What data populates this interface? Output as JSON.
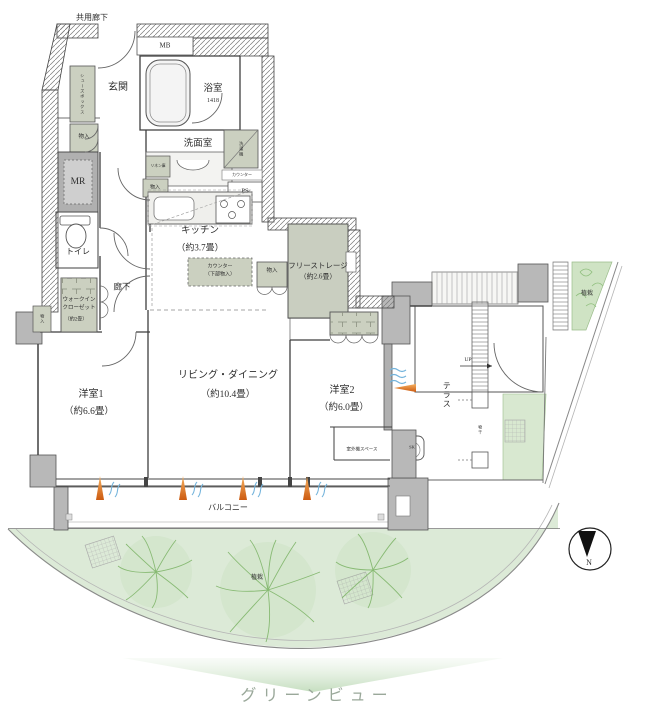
{
  "plan": {
    "exterior": {
      "common_corridor": "共用廊下",
      "mb": "MB",
      "up": "UP",
      "planting_top": "植栽",
      "planting_garden": "植栽",
      "green_view": "グリーンビュー",
      "north": "N"
    },
    "rooms": {
      "entrance": {
        "label": "玄関"
      },
      "bathroom": {
        "label": "浴室",
        "size": "1418"
      },
      "washroom": {
        "label": "洗面室"
      },
      "kitchen": {
        "label": "キッチン",
        "size": "（約3.7畳）"
      },
      "toilet": {
        "label": "トイレ"
      },
      "hallway": {
        "label": "廊下"
      },
      "bedroom1": {
        "label": "洋室1",
        "size": "（約6.6畳）"
      },
      "living_dining": {
        "label": "リビング・ダイニング",
        "size": "（約10.4畳）"
      },
      "bedroom2": {
        "label": "洋室2",
        "size": "（約6.0畳）"
      },
      "free_storage": {
        "label": "フリーストレージ",
        "size": "（約2.6畳）"
      },
      "walk_in_closet": {
        "line1": "ウォークイン",
        "line2": "クローゼット",
        "size": "（約2畳）"
      },
      "balcony": {
        "label": "バルコニー"
      },
      "terrace": {
        "label": "テラス"
      }
    },
    "fixtures": {
      "meter_room": "MR",
      "pipe_space": "PS",
      "slop_sink": "SK",
      "shoes_box": "シューズボックス",
      "washer": "洗濯機",
      "counter": "カウンター",
      "linen": "リネン庫",
      "storage_entrance": "物入",
      "storage_washroom": "物入",
      "storage_living": "物入",
      "storage_wall": "物入",
      "counter_lower_line1": "カウンター",
      "counter_lower_line2": "（下部物入）",
      "outdoor_unit": "室外機スペース",
      "laundry_pole": "物干"
    },
    "colors": {
      "storage_fill": "#cbd0c0",
      "wall_gray": "#b8b8b8",
      "garden_green": "#dcead7",
      "tree_green": "#7fb569",
      "accent_orange": "#d06010",
      "wave_blue": "#74b4dc"
    }
  }
}
